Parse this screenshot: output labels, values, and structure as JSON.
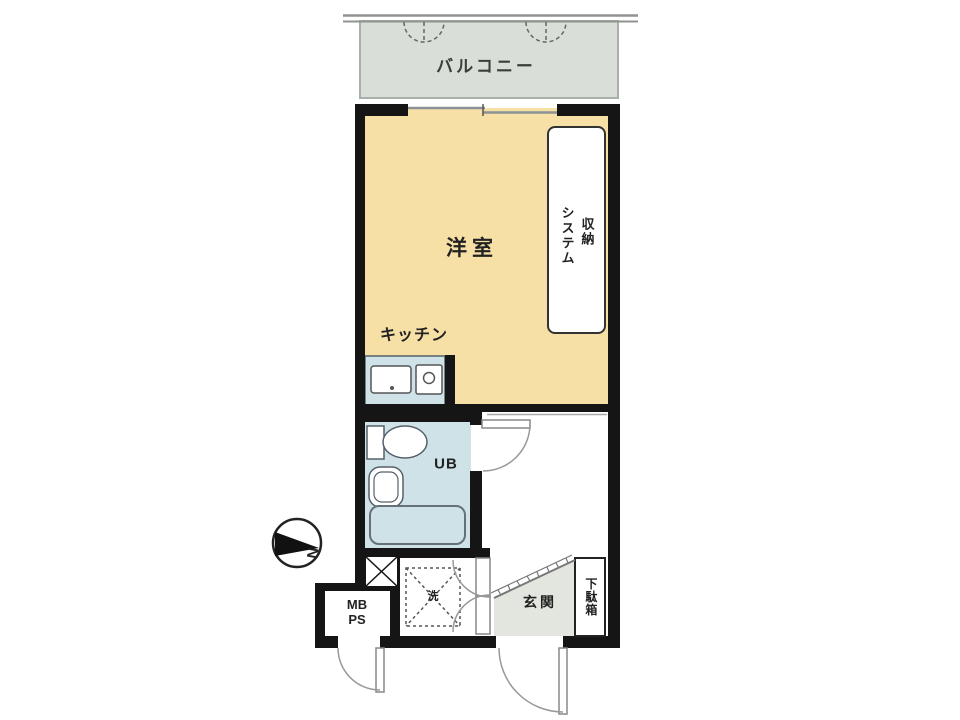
{
  "plan": {
    "balcony": {
      "label": "バルコニー"
    },
    "western_room": {
      "label": "洋室"
    },
    "storage": {
      "label_right_column": "収納",
      "label_left_column": "システム"
    },
    "kitchen": {
      "label": "キッチン"
    },
    "unit_bath": {
      "label": "UB"
    },
    "laundry_space": {
      "label": "洗"
    },
    "meter_box": {
      "line1": "MB",
      "line2": "PS"
    },
    "entrance": {
      "label": "玄関"
    },
    "shoe_cabinet": {
      "label": "下駄箱"
    },
    "compass": {
      "label": "N"
    }
  },
  "colors": {
    "wall": "#151515",
    "room_fill": "#f6e0a6",
    "wet_area_fill": "#cfe2e8",
    "balcony_fill": "#d9ded8",
    "entrance_fill": "#e3e5df",
    "door_arc": "#999999"
  }
}
